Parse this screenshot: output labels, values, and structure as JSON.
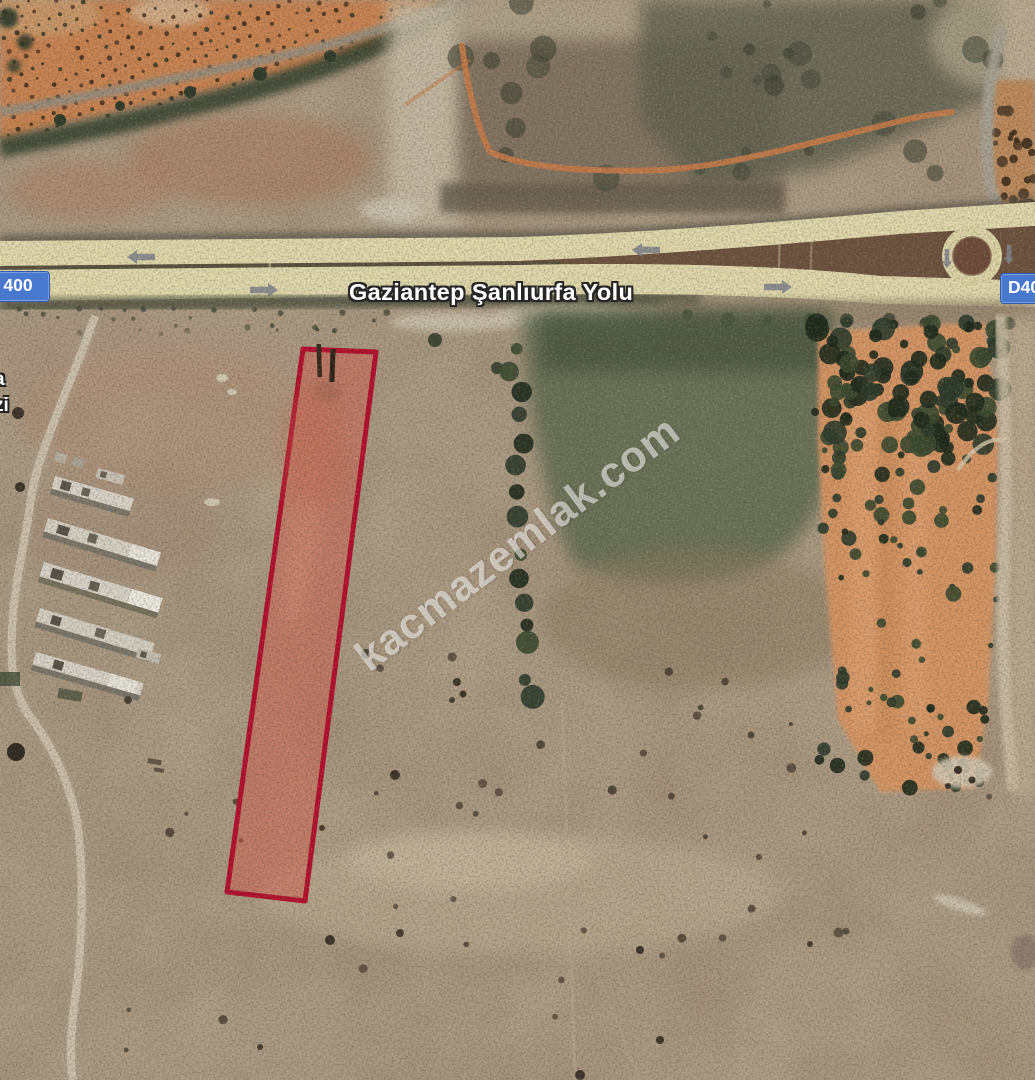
{
  "map": {
    "road_label": "Gaziantep Şanlıurfa Yolu",
    "shield_left_text": "400",
    "shield_right_text": "D40",
    "edge_label_top": "a",
    "edge_label_bottom": "zi",
    "watermark_text": "kacmazemlak.com",
    "colors": {
      "parcel_stroke": "#b40e2f",
      "parcel_fill": "rgba(213,92,75,0.5)",
      "highway_surface": "#e1daad",
      "route_shield_blue": "#4879cf",
      "orchard_soil": "#d99663",
      "terrain_base": "#ab9b84"
    }
  }
}
